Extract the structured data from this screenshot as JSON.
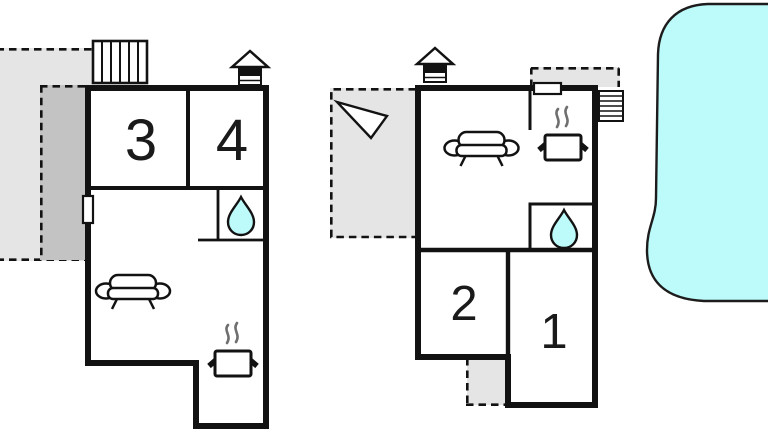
{
  "palette": {
    "background": "#ffffff",
    "wall": "#121212",
    "white": "#ffffff",
    "terrace_light": "#e5e5e5",
    "terrace_dark": "#c3c3c3",
    "water": "#bdfafa",
    "pool_outline": "#1c1c1c",
    "steam": "#6f6f6f",
    "text": "#1a1a1a"
  },
  "floorplan": {
    "rooms": {
      "room1": "1",
      "room2": "2",
      "room3": "3",
      "room4": "4"
    },
    "buildings": {
      "left": {
        "name": "building-left",
        "room_labels": [
          "3",
          "4"
        ],
        "icons": [
          "stairs-icon",
          "chimney-icon",
          "window-icon",
          "sofa-icon",
          "stove-icon",
          "water-drop-icon"
        ],
        "outdoor_areas": [
          "terrace-light",
          "terrace-dark"
        ]
      },
      "right": {
        "name": "building-right",
        "room_labels": [
          "2",
          "1"
        ],
        "icons": [
          "chimney-icon",
          "window-icon",
          "stairs-icon",
          "direction-arrow-icon",
          "sofa-icon",
          "stove-icon",
          "water-drop-icon"
        ],
        "outdoor_areas": [
          "terrace-light",
          "roof-terrace",
          "entrance-porch"
        ]
      }
    },
    "pool": {
      "icon": "swimming-pool"
    }
  }
}
